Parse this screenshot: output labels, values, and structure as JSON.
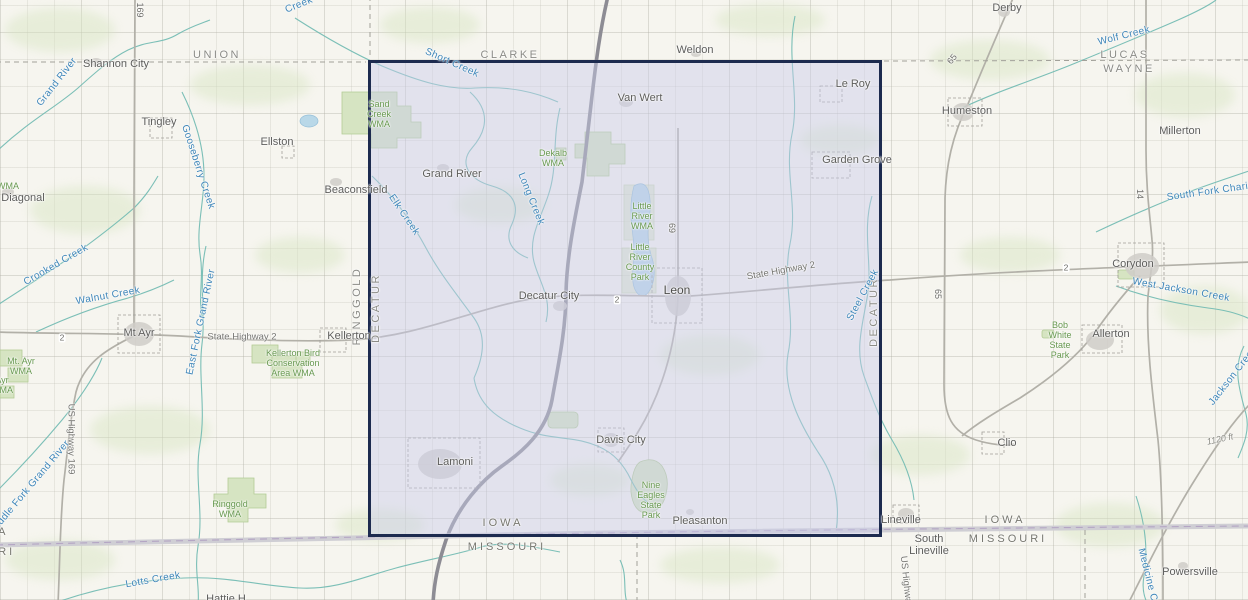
{
  "region": {
    "highlight_fill": "#c9cdea",
    "highlight_border": "#1d2b4f"
  },
  "labels": {
    "counties": [
      "UNION",
      "CLARKE",
      "LUCAS",
      "WAYNE",
      "RINGGOLD",
      "DECATUR",
      "DECATUR"
    ],
    "states": [
      "IOWA",
      "MISSOURI",
      "IOWA",
      "MISSOURI",
      "IOWA",
      "MISSOURI"
    ],
    "towns": [
      "Shannon City",
      "Tingley",
      "Ellston",
      "Diagonal",
      "Beaconsfield",
      "Mt Ayr",
      "Kellerton",
      "Weldon",
      "Van Wert",
      "Le Roy",
      "Garden Grove",
      "Derby",
      "Humeston",
      "Millerton",
      "Corydon",
      "Allerton",
      "Clio",
      "Grand River",
      "Decatur City",
      "Leon",
      "Davis City",
      "Lamoni",
      "Pleasanton",
      "Lineville",
      "South Lineville",
      "Powersville",
      "Hattie H"
    ],
    "waterways": [
      "Grand River",
      "Short Creek",
      "Gooseberry Creek",
      "Creek",
      "Wolf Creek",
      "South Fork Chariton",
      "Crooked Creek",
      "Walnut Creek",
      "East Fork Grand River",
      "Middle Fork Grand River",
      "Elk Creek",
      "Long Creek",
      "Steel Creek",
      "West Jackson Creek",
      "Jackson Creek",
      "Lotts Creek",
      "Medicine Creek"
    ],
    "parks": [
      "Sand Creek WMA",
      "Dekalb WMA",
      "Little River WMA",
      "Little River County Park",
      "Mt. Ayr WMA",
      "Ayr WMA",
      "Kellerton Bird Conservation Area WMA",
      "Ringgold WMA",
      "Bob White State Park",
      "Nine Eagles State Park",
      "WMA"
    ],
    "roads": [
      "State Highway 2",
      "State Highway 2",
      "US Highway 169",
      "169",
      "69",
      "65",
      "65",
      "14",
      "2",
      "2",
      "2",
      "1120 ft",
      "US Highway"
    ]
  }
}
